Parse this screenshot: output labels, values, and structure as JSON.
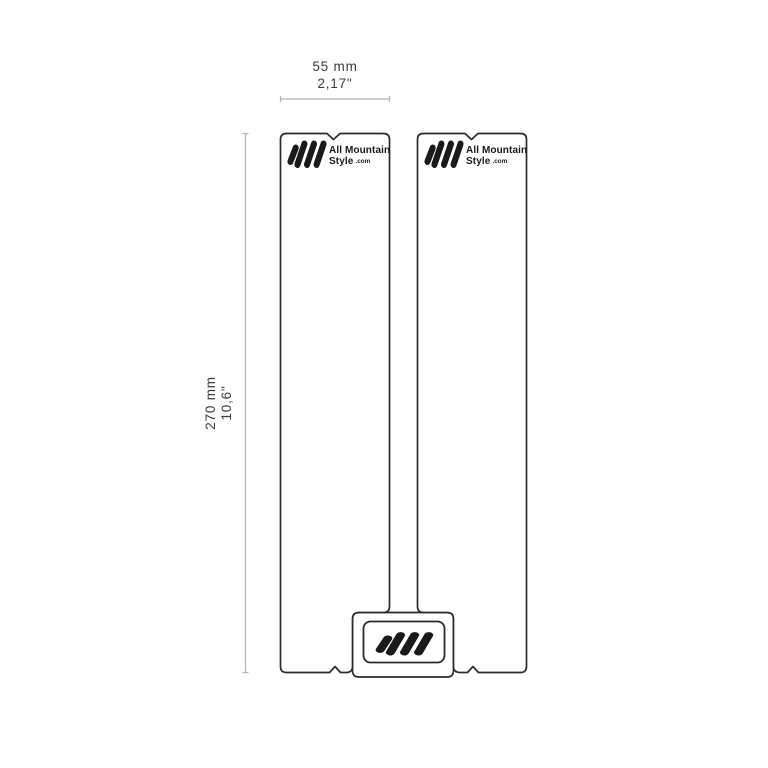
{
  "diagram": {
    "title": "frame-guard-dimension-diagram",
    "width_dimension": {
      "metric": "55 mm",
      "imperial": "2,17\""
    },
    "height_dimension": {
      "metric": "270 mm",
      "imperial": "10,6\""
    },
    "logo": {
      "line1": "All Mountain",
      "line2": "Style",
      "suffix": ".com"
    },
    "colors": {
      "outline": "#2b2b2b",
      "dimension": "#b3b3b3",
      "text": "#3c3c3c",
      "background": "#ffffff",
      "logo": "#1a1a1a"
    }
  }
}
